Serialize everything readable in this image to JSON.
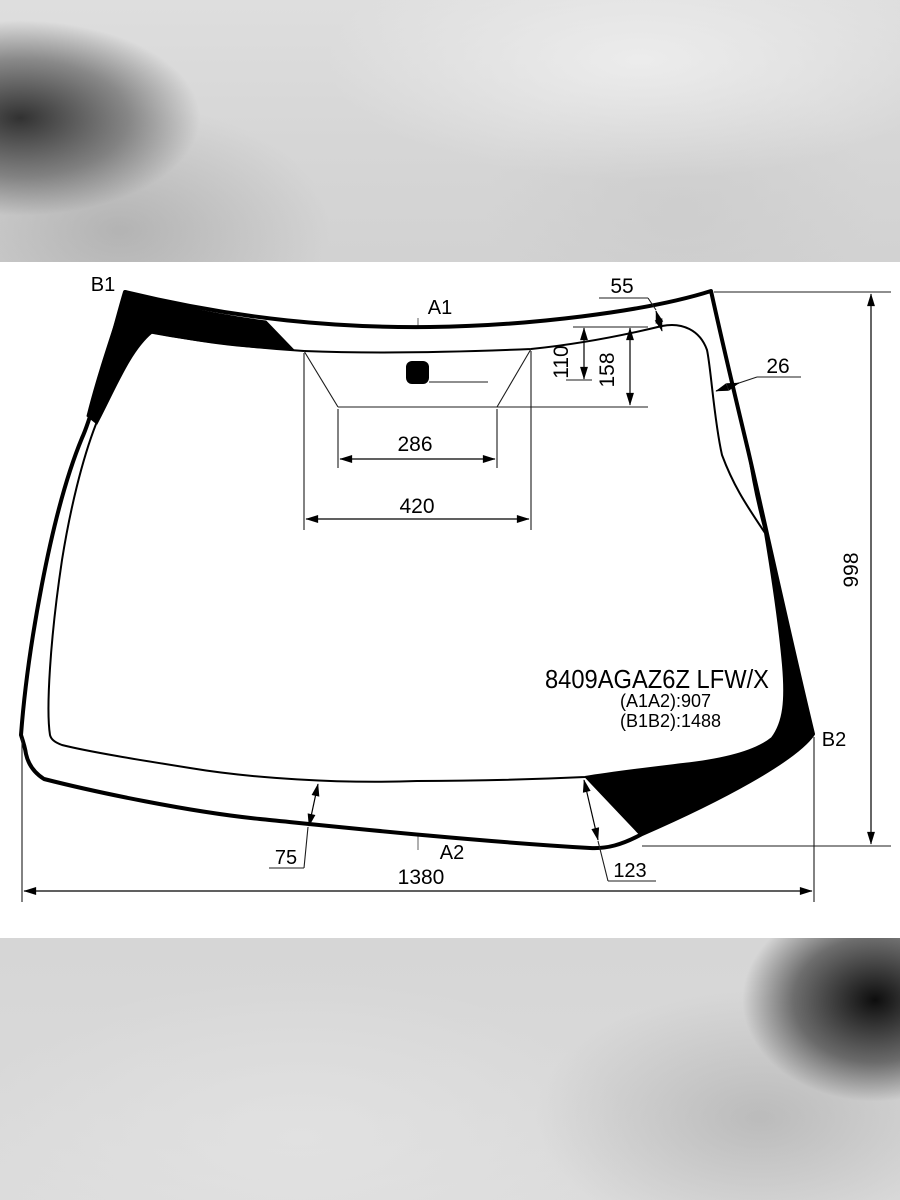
{
  "part": {
    "code": "8409AGAZ6Z LFW/X",
    "a1a2": "(A1A2):907",
    "b1b2": "(B1B2):1488"
  },
  "labels": {
    "b1": "B1",
    "a1": "A1",
    "b2": "B2",
    "a2": "A2"
  },
  "dims": {
    "top_band": "55",
    "mirror_drop": "110",
    "sensor_drop": "158",
    "side_band": "26",
    "sensor_width": "286",
    "sensor_outer_width": "420",
    "glass_height": "998",
    "bottom_band_left": "75",
    "bottom_band_right": "123",
    "glass_width": "1380"
  },
  "colors": {
    "line": "#000000",
    "centerline": "#8f8f8f",
    "glass_fill": "#ffffff",
    "frit_fill": "#000000"
  }
}
